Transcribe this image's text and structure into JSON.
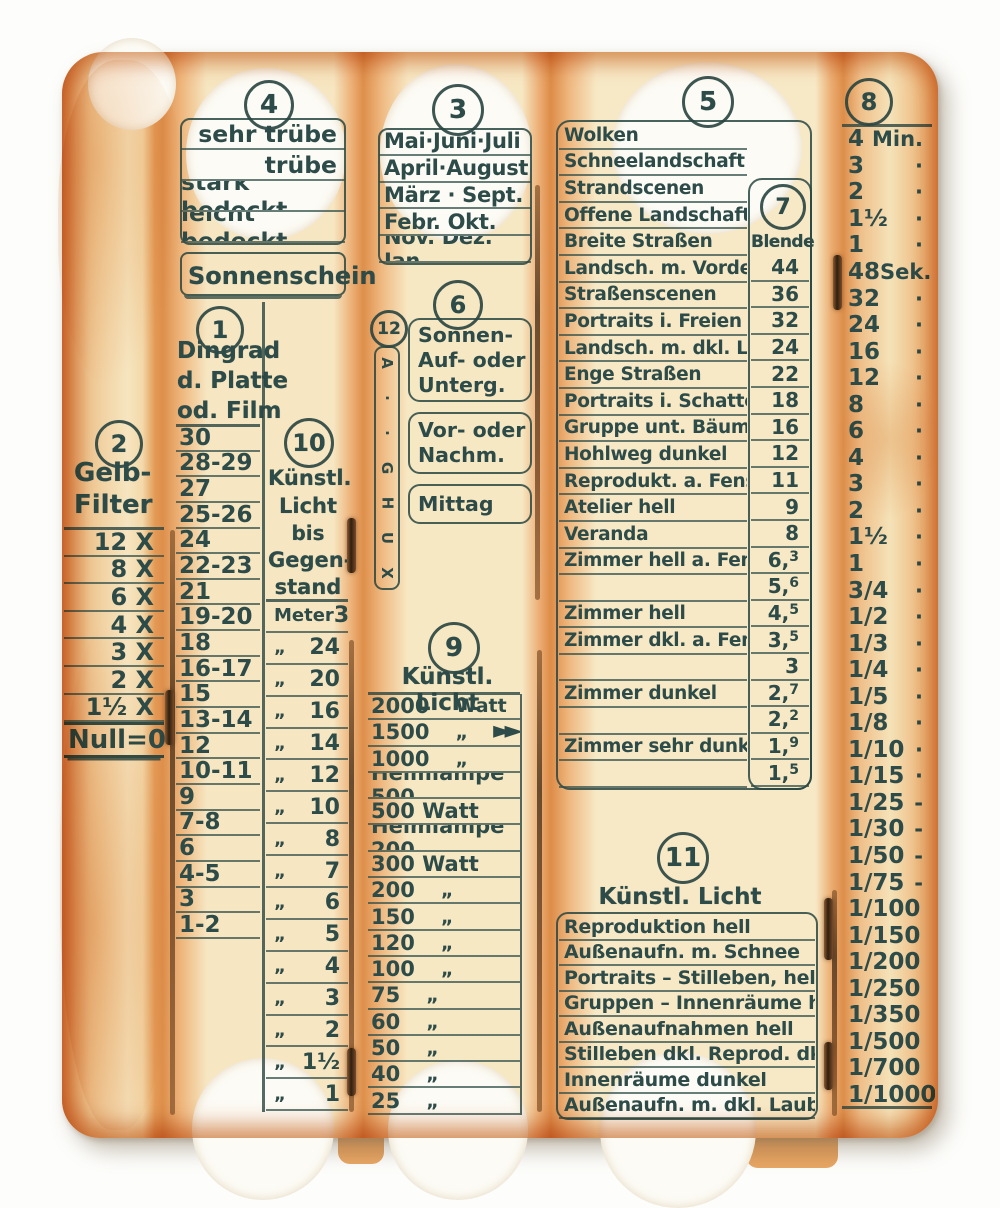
{
  "colors": {
    "ink": "#2d4b48",
    "paper": "#f6e6c1",
    "edge_orange": "#dd8f4b",
    "backing_white": "#fcfbf5"
  },
  "scales": {
    "filter": {
      "num": "2",
      "title1": "Gelb-",
      "title2": "Filter",
      "rows": [
        "12 X",
        "8 X",
        "6 X",
        "4 X",
        "3 X",
        "2 X",
        "1½ X"
      ],
      "zero": "Null=0"
    },
    "weather": {
      "num": "4",
      "rows": [
        "sehr trübe",
        "trübe",
        "stark bedeckt",
        "leicht bedeckt"
      ],
      "sun": "Sonnenschein"
    },
    "film": {
      "num": "1",
      "header1": "Dingrad",
      "header2": "d. Platte",
      "header3": "od. Film",
      "rows": [
        "30",
        "28-29",
        "27",
        "25-26",
        "24",
        "22-23",
        "21",
        "19-20",
        "18",
        "16-17",
        "15",
        "13-14",
        "12",
        "10-11",
        "9",
        "7-8",
        "6",
        "4-5",
        "3",
        "1-2"
      ]
    },
    "distance": {
      "num": "10",
      "header1": "Künstl.",
      "header2": "Licht",
      "header3": "bis",
      "header4": "Gegen-",
      "header5": "stand",
      "rows": [
        {
          "m": "Meter",
          "v": "30"
        },
        {
          "m": "„",
          "v": "24"
        },
        {
          "m": "„",
          "v": "20"
        },
        {
          "m": "„",
          "v": "16"
        },
        {
          "m": "„",
          "v": "14"
        },
        {
          "m": "„",
          "v": "12"
        },
        {
          "m": "„",
          "v": "10"
        },
        {
          "m": "„",
          "v": "8"
        },
        {
          "m": "„",
          "v": "7"
        },
        {
          "m": "„",
          "v": "6"
        },
        {
          "m": "„",
          "v": "5"
        },
        {
          "m": "„",
          "v": "4"
        },
        {
          "m": "„",
          "v": "3"
        },
        {
          "m": "„",
          "v": "2"
        },
        {
          "m": "„",
          "v": "1½"
        },
        {
          "m": "„",
          "v": "1"
        }
      ]
    },
    "months": {
      "num": "3",
      "rows": [
        "Mai·Juni·Juli",
        "April·August",
        "März · Sept.",
        "Febr.  Okt.",
        "Nov. Dez. Jan."
      ]
    },
    "letters": {
      "num": "12",
      "glyphs": [
        "A",
        "·",
        "·",
        "G",
        "H",
        "U",
        "X"
      ]
    },
    "daytime": {
      "num": "6",
      "box1": [
        "Sonnen-",
        "Auf- oder",
        "Unterg."
      ],
      "box2": [
        "Vor- oder",
        "Nachm."
      ],
      "box3": [
        "Mittag"
      ]
    },
    "watt": {
      "num": "9",
      "title": "Künstl. Licht",
      "rows": [
        {
          "t": "2000",
          "u": "Watt"
        },
        {
          "t": "1500",
          "u": "„",
          "arrow": "►►"
        },
        {
          "t": "1000",
          "u": "„"
        },
        {
          "t": "Heimlampe 500",
          "u": ""
        },
        {
          "t": "500 Watt",
          "u": ""
        },
        {
          "t": "Heimlampe 200",
          "u": ""
        },
        {
          "t": "300 Watt",
          "u": ""
        },
        {
          "t": "200",
          "u": "„"
        },
        {
          "t": "150",
          "u": "„"
        },
        {
          "t": "120",
          "u": "„"
        },
        {
          "t": "100",
          "u": "„"
        },
        {
          "t": "75",
          "u": "„"
        },
        {
          "t": "60",
          "u": "„"
        },
        {
          "t": "50",
          "u": "„"
        },
        {
          "t": "40",
          "u": "„"
        },
        {
          "t": "25",
          "u": "„"
        }
      ]
    },
    "scenes": {
      "num": "5",
      "rows": [
        {
          "label": "Wolken"
        },
        {
          "label": "Schneelandschaft"
        },
        {
          "label": "Strandscenen"
        },
        {
          "label": "Offene Landschaft"
        },
        {
          "label": "Breite Straßen"
        },
        {
          "label": "Landsch. m. Vordergr."
        },
        {
          "label": "Straßenscenen"
        },
        {
          "label": "Portraits i. Freien"
        },
        {
          "label": "Landsch. m. dkl. Laub"
        },
        {
          "label": "Enge Straßen"
        },
        {
          "label": "Portraits i. Schatten"
        },
        {
          "label": "Gruppe unt. Bäumen"
        },
        {
          "label": "Hohlweg dunkel"
        },
        {
          "label": "Reprodukt. a. Fenster"
        },
        {
          "label": "Atelier hell"
        },
        {
          "label": "Veranda"
        },
        {
          "label": "Zimmer hell a. Fenster"
        },
        {
          "label": ""
        },
        {
          "label": "Zimmer hell"
        },
        {
          "label": "Zimmer dkl. a. Fenster"
        },
        {
          "label": ""
        },
        {
          "label": "Zimmer dunkel"
        },
        {
          "label": ""
        },
        {
          "label": "Zimmer sehr dunkel"
        },
        {
          "label": ""
        }
      ]
    },
    "blende": {
      "num": "7",
      "label": "Blende",
      "rows": [
        {
          "a": "44",
          "b": ""
        },
        {
          "a": "36",
          "b": ""
        },
        {
          "a": "32",
          "b": ""
        },
        {
          "a": "24",
          "b": ""
        },
        {
          "a": "22",
          "b": ""
        },
        {
          "a": "18",
          "b": ""
        },
        {
          "a": "16",
          "b": ""
        },
        {
          "a": "12",
          "b": ""
        },
        {
          "a": "11",
          "b": ""
        },
        {
          "a": "9",
          "b": ""
        },
        {
          "a": "8",
          "b": ""
        },
        {
          "a": "6,",
          "b": "3"
        },
        {
          "a": "5,",
          "b": "6"
        },
        {
          "a": "4,",
          "b": "5"
        },
        {
          "a": "3,",
          "b": "5"
        },
        {
          "a": "3",
          "b": ""
        },
        {
          "a": "2,",
          "b": "7"
        },
        {
          "a": "2,",
          "b": "2"
        },
        {
          "a": "1,",
          "b": "9"
        },
        {
          "a": "1,",
          "b": "5"
        }
      ]
    },
    "artificial": {
      "num": "11",
      "title": "Künstl. Licht",
      "rows": [
        "Reproduktion hell",
        "Außenaufn.  m. Schnee",
        "Portraits – Stilleben, hell",
        "Gruppen – Innenräume hell",
        "Außenaufnahmen hell",
        "Stilleben dkl. Reprod. dkl.",
        "Innenräume dunkel",
        "Außenaufn. m. dkl. Laub"
      ]
    },
    "times": {
      "num": "8",
      "rows": [
        {
          "v": "4",
          "u": "Min."
        },
        {
          "v": "3",
          "u": "·"
        },
        {
          "v": "2",
          "u": "·"
        },
        {
          "v": "1½",
          "u": "·"
        },
        {
          "v": "1",
          "u": "·"
        },
        {
          "v": "48",
          "u": "Sek."
        },
        {
          "v": "32",
          "u": "·"
        },
        {
          "v": "24",
          "u": "·"
        },
        {
          "v": "16",
          "u": "·"
        },
        {
          "v": "12",
          "u": "·"
        },
        {
          "v": "8",
          "u": "·"
        },
        {
          "v": "6",
          "u": "·"
        },
        {
          "v": "4",
          "u": "·"
        },
        {
          "v": "3",
          "u": "·"
        },
        {
          "v": "2",
          "u": "·"
        },
        {
          "v": "1½",
          "u": "·"
        },
        {
          "v": "1",
          "u": "·"
        },
        {
          "v": "3/4",
          "u": "·"
        },
        {
          "v": "1/2",
          "u": "·"
        },
        {
          "v": "1/3",
          "u": "·"
        },
        {
          "v": "1/4",
          "u": "·"
        },
        {
          "v": "1/5",
          "u": "·"
        },
        {
          "v": "1/8",
          "u": "·"
        },
        {
          "v": "1/10",
          "u": "·"
        },
        {
          "v": "1/15",
          "u": "·"
        },
        {
          "v": "1/25",
          "u": "-"
        },
        {
          "v": "1/30",
          "u": "-"
        },
        {
          "v": "1/50",
          "u": "-"
        },
        {
          "v": "1/75",
          "u": "-"
        },
        {
          "v": "1/100",
          "u": ""
        },
        {
          "v": "1/150",
          "u": ""
        },
        {
          "v": "1/200",
          "u": ""
        },
        {
          "v": "1/250",
          "u": ""
        },
        {
          "v": "1/350",
          "u": ""
        },
        {
          "v": "1/500",
          "u": ""
        },
        {
          "v": "1/700",
          "u": ""
        },
        {
          "v": "1/1000",
          "u": ""
        }
      ]
    }
  }
}
